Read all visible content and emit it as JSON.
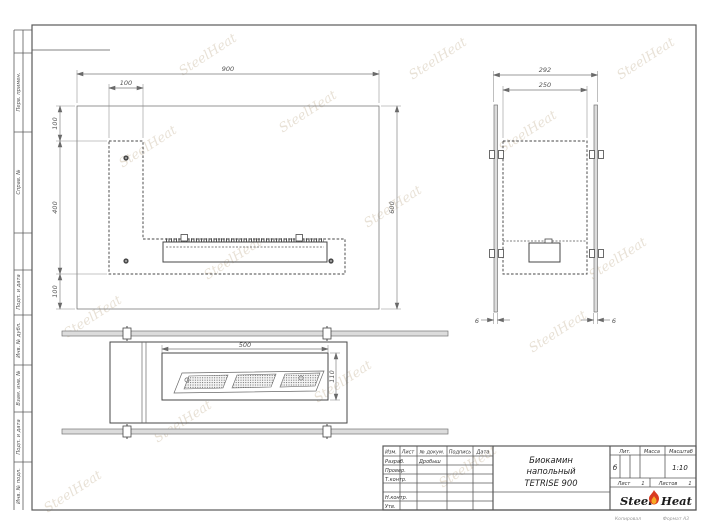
{
  "watermark": {
    "text": "SteelHeat"
  },
  "margin_labels": [
    "Перв. примен.",
    "Справ. №",
    "Подп. и дата",
    "Инв. № дубл.",
    "Взам. инв. №",
    "Подп. и дата",
    "Инв. № подл."
  ],
  "front_view": {
    "dims": {
      "width": "900",
      "leg": "100",
      "seg_top": "100",
      "seg_mid": "400",
      "seg_bottom": "100",
      "height": "600"
    }
  },
  "side_view": {
    "dims": {
      "outer": "292",
      "inner": "250",
      "glass_left": "6",
      "glass_right": "6"
    }
  },
  "top_view": {
    "dims": {
      "burner_width": "500",
      "burner_depth": "110"
    }
  },
  "title_block": {
    "columns": [
      "Изм.",
      "Лист",
      "№ докум.",
      "Подпись",
      "Дата"
    ],
    "rows": [
      {
        "label": "Разраб.",
        "name": "Дробыш"
      },
      {
        "label": "Провер.",
        "name": ""
      },
      {
        "label": "Т.контр.",
        "name": ""
      },
      {
        "label": "",
        "name": ""
      },
      {
        "label": "Н.контр.",
        "name": ""
      },
      {
        "label": "Утв.",
        "name": ""
      }
    ],
    "doc_title_line1": "Биокамин",
    "doc_title_line2": "напольный",
    "doc_title_line3": "TETRISE 900",
    "lit_label": "Лит.",
    "lit_value": "б",
    "mass_label": "Масса",
    "scale_label": "Масштаб",
    "scale_value": "1:10",
    "sheet_label": "Лист",
    "sheet_value": "1",
    "sheets_label": "Листов",
    "sheets_value": "1",
    "logo": {
      "part1": "Steel",
      "part2": "Heat"
    },
    "footer_left": "Копировал",
    "footer_right": "Формат А3"
  },
  "colors": {
    "line": "#474747",
    "accent_flame_red": "#d93a20",
    "accent_flame_orange": "#f7a823",
    "watermark": "#b29c76"
  }
}
